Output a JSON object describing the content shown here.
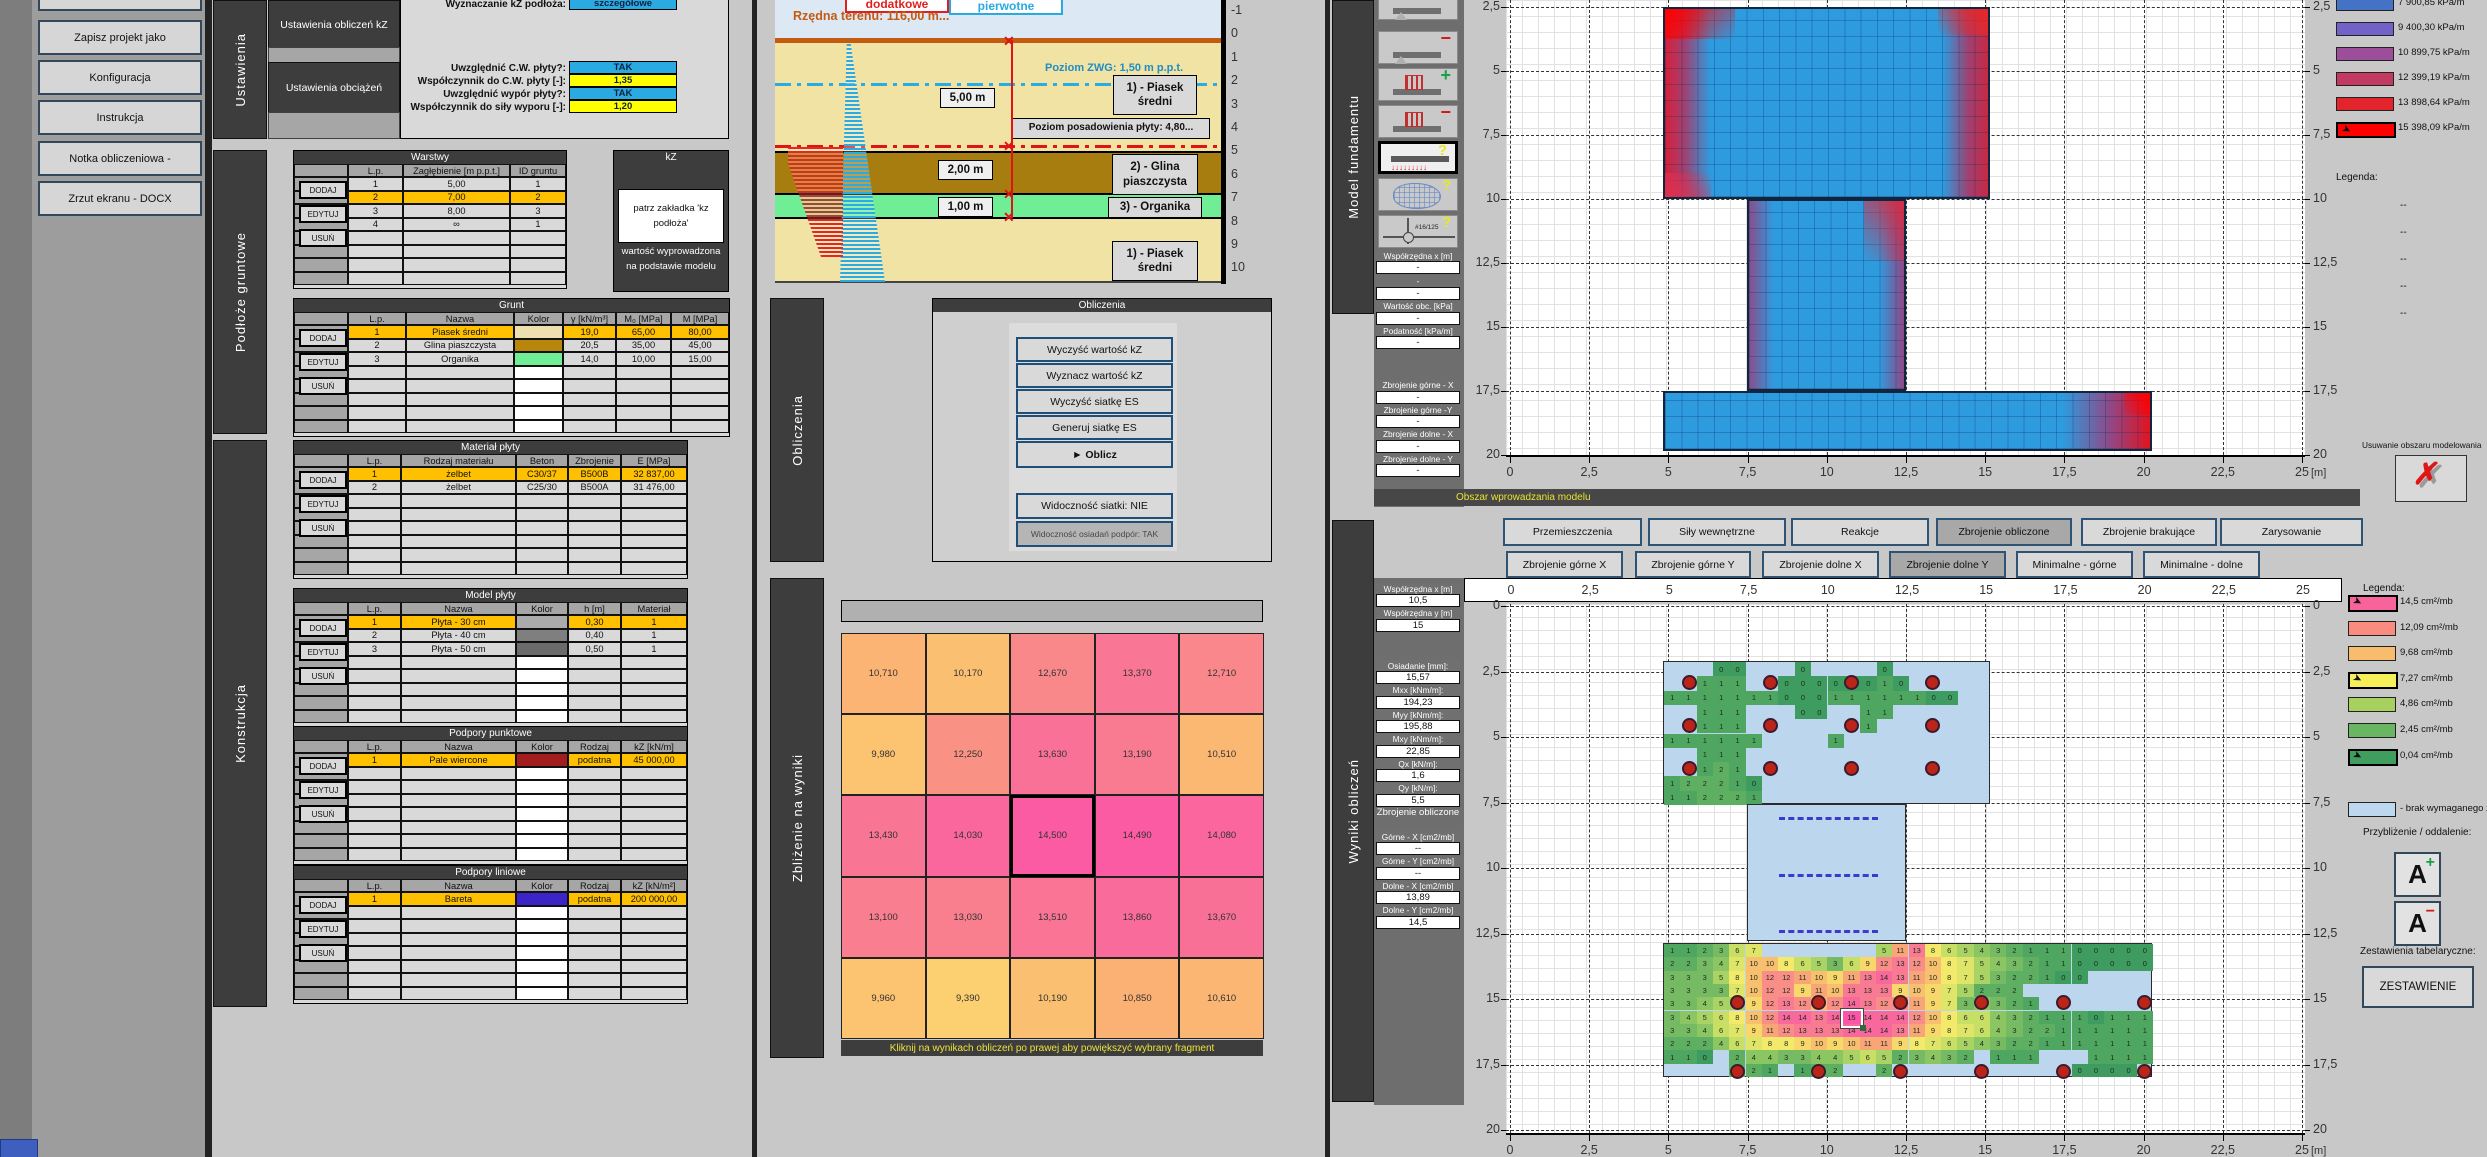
{
  "toolbar": {
    "buttons": [
      "Zapisz projekt jako",
      "Konfiguracja",
      "Instrukcja",
      "Notka obliczeniowa -",
      "Zrzut ekranu - DOCX"
    ]
  },
  "tabs": {
    "ustawienia": "Ustawienia",
    "podloze": "Podłoże  gruntowe",
    "konstrukcja": "Konstrukcja",
    "obliczenia": "Obliczenia",
    "zblizenie": "Zbliżenie na wyniki",
    "model": "Model fundamentu",
    "wyniki": "Wyniki obliczeń"
  },
  "settings": {
    "buttons": [
      "Ustawienia obliczeń kZ",
      "Ustawienia obciążeń"
    ],
    "rows": [
      {
        "label": "Wyznaczanie kZ podłoża:",
        "value": "szczegółowe",
        "type": "blue"
      },
      {
        "label": "Uwzględnić C.W. płyty?:",
        "value": "TAK",
        "type": "blue"
      },
      {
        "label": "Współczynnik do C.W. płyty [-]:",
        "value": "1,35",
        "type": "yellow"
      },
      {
        "label": "Uwzględnić wypór płyty?:",
        "value": "TAK",
        "type": "blue"
      },
      {
        "label": "Współczynnik do siły wyporu [-]:",
        "value": "1,20",
        "type": "yellow"
      }
    ]
  },
  "actions": [
    "DODAJ",
    "EDYTUJ",
    "USUŃ"
  ],
  "tables": {
    "warstwy": {
      "title": "Warstwy",
      "headers": [
        "L.p.",
        "Zagłębienie [m p.p.t.]",
        "ID gruntu"
      ],
      "rows": [
        [
          "1",
          "5,00",
          "1"
        ],
        [
          "2",
          "7,00",
          "2"
        ],
        [
          "3",
          "8,00",
          "3"
        ],
        [
          "4",
          "∞",
          "1"
        ]
      ],
      "highlight": 1,
      "empty": 4
    },
    "grunt": {
      "title": "Grunt",
      "headers": [
        "L.p.",
        "Nazwa",
        "Kolor",
        "γ [kN/m³]",
        "M₀ [MPa]",
        "M [MPa]"
      ],
      "rows": [
        [
          "1",
          "Piasek średni",
          "#EDE0AE",
          "19,0",
          "65,00",
          "80,00"
        ],
        [
          "2",
          "Glina piaszczysta",
          "#B8860B",
          "20,5",
          "35,00",
          "45,00"
        ],
        [
          "3",
          "Organika",
          "#70EE96",
          "14,0",
          "10,00",
          "15,00"
        ]
      ],
      "color_col": 2,
      "highlight": 0,
      "empty": 5
    },
    "material": {
      "title": "Materiał płyty",
      "headers": [
        "L.p.",
        "Rodzaj materiału",
        "Beton",
        "Zbrojenie",
        "E [MPa]"
      ],
      "rows": [
        [
          "1",
          "żelbet",
          "C30/37",
          "B500B",
          "32 837,00"
        ],
        [
          "2",
          "żelbet",
          "C25/30",
          "B500A",
          "31 476,00"
        ]
      ],
      "highlight": 0,
      "empty": 6
    },
    "model_plyty": {
      "title": "Model płyty",
      "headers": [
        "L.p.",
        "Nazwa",
        "Kolor",
        "h [m]",
        "Materiał"
      ],
      "rows": [
        [
          "1",
          "Płyta - 30 cm",
          "#ABABAB",
          "0,30",
          "1"
        ],
        [
          "2",
          "Płyta - 40 cm",
          "#7F7F7F",
          "0,40",
          "1"
        ],
        [
          "3",
          "Płyta - 50 cm",
          "#6B6B6B",
          "0,50",
          "1"
        ]
      ],
      "color_col": 2,
      "highlight": 0,
      "empty": 5
    },
    "podpory_punktowe": {
      "title": "Podpory punktowe",
      "headers": [
        "L.p.",
        "Nazwa",
        "Kolor",
        "Rodzaj",
        "kZ [kN/m]"
      ],
      "rows": [
        [
          "1",
          "Pale wiercone",
          "#A21E1E",
          "podatna",
          "45 000,00"
        ]
      ],
      "color_col": 2,
      "highlight": 0,
      "empty": 7
    },
    "podpory_liniowe": {
      "title": "Podpory liniowe",
      "headers": [
        "L.p.",
        "Nazwa",
        "Kolor",
        "Rodzaj",
        "kZ [kN/m²]"
      ],
      "rows": [
        [
          "1",
          "Bareta",
          "#3B24C8",
          "podatna",
          "200 000,00"
        ]
      ],
      "color_col": 2,
      "highlight": 0,
      "empty": 7
    }
  },
  "kz_panel": {
    "title": "kZ",
    "note": "patrz zakładka 'kz podłoża'",
    "note2": "wartość wyprowadzona na podstawie modelu"
  },
  "soil": {
    "legend_add": "dodatkowe",
    "legend_prim": "pierwotne",
    "terrain": "Rzędna terenu: 116,00  m...",
    "zwg": "Poziom ZWG: 1,50  m p.p.t.",
    "founding": "Poziom posadowienia płyty: 4,80...",
    "dim1": "5,00 m",
    "dim2": "2,00 m",
    "dim3": "1,00 m",
    "layer1": "1)  - Piasek średni",
    "layer2": "2)  - Glina piaszczysta",
    "layer3": "3)  - Organika",
    "layer1b": "1)  - Piasek średni",
    "axis": [
      "-1",
      "0",
      "1",
      "2",
      "3",
      "4",
      "5",
      "6",
      "7",
      "8",
      "9",
      "10"
    ]
  },
  "calc": {
    "title": "Obliczenia",
    "buttons": [
      "Wyczyść wartość kZ",
      "Wyznacz wartość kZ",
      "Wyczyść siatkę ES",
      "Generuj siatkę ES",
      "► Oblicz"
    ],
    "toggle1": "Widoczność siatki: NIE",
    "toggle2": "Widoczność osiadań podpór: TAK"
  },
  "zoom_panel": {
    "caption": "Kliknij na wynikach obliczeń po prawej aby powiększyć wybrany fragment",
    "values": [
      [
        "10,710",
        "10,170",
        "12,670",
        "13,370",
        "12,710"
      ],
      [
        "9,980",
        "12,250",
        "13,630",
        "13,190",
        "10,510"
      ],
      [
        "13,430",
        "14,030",
        "14,500",
        "14,490",
        "14,080"
      ],
      [
        "13,100",
        "13,030",
        "13,510",
        "13,860",
        "13,670"
      ],
      [
        "9,960",
        "9,390",
        "10,190",
        "10,850",
        "10,610"
      ]
    ],
    "selected_row": 2,
    "selected_col": 2
  },
  "model_panel": {
    "icons": [
      {
        "id": "beam-support-add-icon",
        "kind": "beam",
        "sign": "+"
      },
      {
        "id": "beam-support-remove-icon",
        "kind": "beam",
        "sign": "−"
      },
      {
        "id": "load-add-icon",
        "kind": "load",
        "sign": "+"
      },
      {
        "id": "load-remove-icon",
        "kind": "load",
        "sign": "−"
      },
      {
        "id": "load-edit-icon",
        "kind": "arrows",
        "sign": "?",
        "selected": true
      },
      {
        "id": "mesh-edit-icon",
        "kind": "mesh",
        "sign": "?"
      },
      {
        "id": "rebar-edit-icon",
        "kind": "rebar",
        "sign": "?",
        "text": "#16/125"
      }
    ],
    "fields": [
      {
        "t": "label",
        "v": "Współrzędna x [m]"
      },
      {
        "t": "val",
        "v": "-"
      },
      {
        "t": "dval",
        "v": "-"
      },
      {
        "t": "val",
        "v": "-"
      },
      {
        "t": "label",
        "v": "Wartość obc. [kPa]"
      },
      {
        "t": "val",
        "v": "-"
      },
      {
        "t": "label",
        "v": "Podatność [kPa/m]"
      },
      {
        "t": "val",
        "v": "-"
      },
      {
        "t": "gap",
        "h": 30
      },
      {
        "t": "label",
        "v": "Zbrojenie górne - X"
      },
      {
        "t": "val",
        "v": "-"
      },
      {
        "t": "label",
        "v": "Zbrojenie górne -Y"
      },
      {
        "t": "val",
        "v": "-"
      },
      {
        "t": "label",
        "v": "Zbrojenie dolne - X"
      },
      {
        "t": "val",
        "v": "-"
      },
      {
        "t": "label",
        "v": "Zbrojenie dolne - Y"
      },
      {
        "t": "val",
        "v": "-"
      }
    ],
    "status": "Obszar wprowadzania modelu",
    "legend_title": "Legenda:",
    "legend": [
      {
        "color": "#4472C4",
        "label": "7 900,85 kPa/m"
      },
      {
        "color": "#7262C8",
        "label": "9 400,30 kPa/m"
      },
      {
        "color": "#9C4E9A",
        "label": "10 899,75 kPa/m"
      },
      {
        "color": "#C23A62",
        "label": "12 399,19 kPa/m"
      },
      {
        "color": "#E3242D",
        "label": "13 898,64 kPa/m"
      },
      {
        "color": "#FF0000",
        "label": "15 398,09 kPa/m",
        "selected": true
      }
    ],
    "legend_dashes": [
      "--",
      "--",
      "--",
      "--",
      "--"
    ],
    "delete_label": "Usuwanie obszaru modelowania",
    "x_ticks": [
      "0",
      "2,5",
      "5",
      "7,5",
      "10",
      "12,5",
      "15",
      "17,5",
      "20",
      "22,5",
      "25"
    ],
    "y_ticks": [
      "2,5",
      "5",
      "7,5",
      "10",
      "12,5",
      "15",
      "17,5",
      "20"
    ],
    "unit": "[m]"
  },
  "results_tabs": {
    "row1": [
      {
        "label": "Przemieszczenia"
      },
      {
        "label": "Siły wewnętrzne"
      },
      {
        "label": "Reakcje"
      },
      {
        "label": "Zbrojenie obliczone",
        "selected": true
      },
      {
        "label": "Zbrojenie brakujące"
      },
      {
        "label": "Zarysowanie"
      }
    ],
    "row2": [
      {
        "label": "Zbrojenie górne X"
      },
      {
        "label": "Zbrojenie górne Y"
      },
      {
        "label": "Zbrojenie dolne X"
      },
      {
        "label": "Zbrojenie dolne Y",
        "selected": true
      },
      {
        "label": "Minimalne - górne"
      },
      {
        "label": "Minimalne - dolne"
      }
    ]
  },
  "results_panel": {
    "fields": [
      {
        "t": "label",
        "v": "Współrzędna x [m]"
      },
      {
        "t": "val",
        "v": "10,5"
      },
      {
        "t": "label",
        "v": "Współrzędna y [m]"
      },
      {
        "t": "val",
        "v": "15"
      },
      {
        "t": "gap",
        "h": 28
      },
      {
        "t": "label",
        "v": "Osiadanie [mm]:"
      },
      {
        "t": "val",
        "v": "15,57"
      },
      {
        "t": "label",
        "v": "Mxx [kNm/m]:"
      },
      {
        "t": "val",
        "v": "194,23"
      },
      {
        "t": "label",
        "v": "Myy [kNm/m]:"
      },
      {
        "t": "val",
        "v": "195,88"
      },
      {
        "t": "label",
        "v": "Mxy [kNm/m]:"
      },
      {
        "t": "val",
        "v": "22,85"
      },
      {
        "t": "label",
        "v": "Qx [kN/m]:"
      },
      {
        "t": "val",
        "v": "1,6"
      },
      {
        "t": "label",
        "v": "Qy [kN/m]:"
      },
      {
        "t": "val",
        "v": "5,5"
      },
      {
        "t": "header",
        "v": "Zbrojenie obliczone"
      },
      {
        "t": "label",
        "v": "Górne - X [cm2/mb]"
      },
      {
        "t": "val",
        "v": "--"
      },
      {
        "t": "label",
        "v": "Górne - Y [cm2/mb]"
      },
      {
        "t": "val",
        "v": "--"
      },
      {
        "t": "label",
        "v": "Dolne - X [cm2/mb]"
      },
      {
        "t": "val",
        "v": "13,89"
      },
      {
        "t": "label",
        "v": "Dolne - Y [cm2/mb]"
      },
      {
        "t": "val",
        "v": "14,5"
      }
    ],
    "legend_title": "Legenda:",
    "legend": [
      {
        "color": "#F9639B",
        "label": "14,5 cm²/mb",
        "selected": true
      },
      {
        "color": "#F98B80",
        "label": "12,09 cm²/mb"
      },
      {
        "color": "#F8BC6E",
        "label": "9,68 cm²/mb"
      },
      {
        "color": "#F5F05A",
        "label": "7,27 cm²/mb",
        "selected": true
      },
      {
        "color": "#A8D05E",
        "label": "4,86 cm²/mb"
      },
      {
        "color": "#69B561",
        "label": "2,45 cm²/mb"
      },
      {
        "color": "#3F9D5F",
        "label": "0,04 cm²/mb",
        "selected": true
      }
    ],
    "legend_none": {
      "color": "#BDD7EE",
      "label": "- brak wymaganego z"
    },
    "zoom_label": "Przybliżenie / oddalenie:",
    "tables_label": "Zestawienia tabelaryczne:",
    "zestawienie": "ZESTAWIENIE",
    "x_ticks": [
      "0",
      "2,5",
      "5",
      "7,5",
      "10",
      "12,5",
      "15",
      "17,5",
      "20",
      "22,5",
      "25"
    ],
    "y_ticks": [
      "0",
      "2,5",
      "5",
      "7,5",
      "10",
      "12,5",
      "15",
      "17,5",
      "20"
    ],
    "unit": "[m]",
    "selected_cell": {
      "row": 5,
      "col": 11
    },
    "top_matrix": [
      [
        null,
        null,
        null,
        0,
        0,
        null,
        null,
        null,
        0,
        null,
        null,
        null,
        null,
        0,
        null,
        null,
        null,
        null,
        null,
        null
      ],
      [
        null,
        null,
        1,
        1,
        1,
        null,
        null,
        0,
        0,
        0,
        0,
        0,
        0,
        1,
        0,
        null,
        null,
        null,
        null,
        null
      ],
      [
        1,
        1,
        1,
        1,
        1,
        1,
        1,
        0,
        0,
        0,
        1,
        1,
        1,
        1,
        1,
        1,
        0,
        0,
        null,
        null
      ],
      [
        null,
        null,
        1,
        1,
        1,
        null,
        null,
        null,
        0,
        0,
        null,
        null,
        1,
        1,
        null,
        null,
        null,
        null,
        null,
        null
      ],
      [
        null,
        null,
        1,
        1,
        1,
        null,
        null,
        null,
        null,
        null,
        null,
        null,
        1,
        null,
        null,
        null,
        null,
        null,
        null,
        null
      ],
      [
        1,
        1,
        1,
        1,
        1,
        1,
        null,
        null,
        null,
        null,
        1,
        null,
        null,
        null,
        null,
        null,
        null,
        null,
        null,
        null
      ],
      [
        null,
        null,
        1,
        1,
        1,
        null,
        null,
        null,
        null,
        null,
        null,
        null,
        null,
        null,
        null,
        null,
        null,
        null,
        null,
        null
      ],
      [
        null,
        null,
        1,
        2,
        1,
        null,
        null,
        null,
        null,
        null,
        null,
        null,
        null,
        null,
        null,
        null,
        null,
        null,
        null,
        null
      ],
      [
        1,
        2,
        2,
        2,
        1,
        0,
        null,
        null,
        null,
        null,
        null,
        null,
        null,
        null,
        null,
        null,
        null,
        null,
        null,
        null
      ],
      [
        1,
        1,
        2,
        2,
        2,
        1,
        null,
        null,
        null,
        null,
        null,
        null,
        null,
        null,
        null,
        null,
        null,
        null,
        null,
        null
      ]
    ],
    "band_matrix": [
      [
        1,
        1,
        2,
        3,
        6,
        7,
        null,
        null,
        null,
        null,
        null,
        null,
        null,
        5,
        11,
        13,
        8,
        6,
        5,
        4,
        3,
        2,
        1,
        1,
        1,
        0,
        0,
        0,
        0,
        0
      ],
      [
        2,
        2,
        3,
        4,
        7,
        10,
        10,
        8,
        6,
        5,
        3,
        6,
        9,
        12,
        13,
        12,
        10,
        8,
        7,
        5,
        4,
        3,
        2,
        1,
        1,
        0,
        0,
        0,
        0,
        0
      ],
      [
        3,
        3,
        3,
        5,
        8,
        10,
        12,
        12,
        11,
        10,
        9,
        11,
        13,
        14,
        13,
        11,
        10,
        8,
        7,
        5,
        3,
        2,
        2,
        1,
        0,
        0,
        null,
        null,
        null,
        null
      ],
      [
        3,
        3,
        3,
        3,
        7,
        10,
        12,
        12,
        9,
        11,
        10,
        13,
        13,
        13,
        9,
        10,
        9,
        7,
        5,
        2,
        2,
        2,
        null,
        null,
        null,
        null,
        null,
        null,
        null,
        null
      ],
      [
        3,
        3,
        4,
        5,
        5,
        9,
        12,
        13,
        12,
        10,
        12,
        14,
        13,
        12,
        12,
        11,
        9,
        7,
        3,
        4,
        3,
        2,
        1,
        null,
        null,
        null,
        null,
        null,
        null,
        null
      ],
      [
        3,
        4,
        5,
        6,
        8,
        10,
        12,
        14,
        14,
        13,
        14,
        15,
        14,
        14,
        14,
        12,
        10,
        8,
        6,
        6,
        4,
        3,
        2,
        1,
        1,
        1,
        0,
        1,
        1,
        1
      ],
      [
        3,
        3,
        4,
        6,
        7,
        9,
        11,
        12,
        13,
        13,
        13,
        14,
        14,
        14,
        13,
        11,
        9,
        8,
        7,
        6,
        4,
        3,
        2,
        2,
        1,
        1,
        1,
        1,
        1,
        1
      ],
      [
        2,
        2,
        2,
        4,
        6,
        7,
        8,
        8,
        9,
        10,
        9,
        10,
        11,
        11,
        9,
        8,
        7,
        6,
        5,
        4,
        3,
        2,
        2,
        1,
        1,
        1,
        1,
        1,
        1,
        1
      ],
      [
        1,
        1,
        0,
        null,
        2,
        4,
        4,
        3,
        3,
        4,
        4,
        5,
        6,
        5,
        2,
        3,
        4,
        3,
        2,
        null,
        1,
        1,
        1,
        null,
        null,
        null,
        1,
        1,
        1,
        1
      ],
      [
        null,
        null,
        null,
        null,
        2,
        2,
        1,
        null,
        1,
        2,
        2,
        null,
        null,
        2,
        null,
        null,
        null,
        null,
        null,
        null,
        null,
        null,
        null,
        null,
        null,
        0,
        0,
        0,
        0,
        null
      ]
    ]
  }
}
